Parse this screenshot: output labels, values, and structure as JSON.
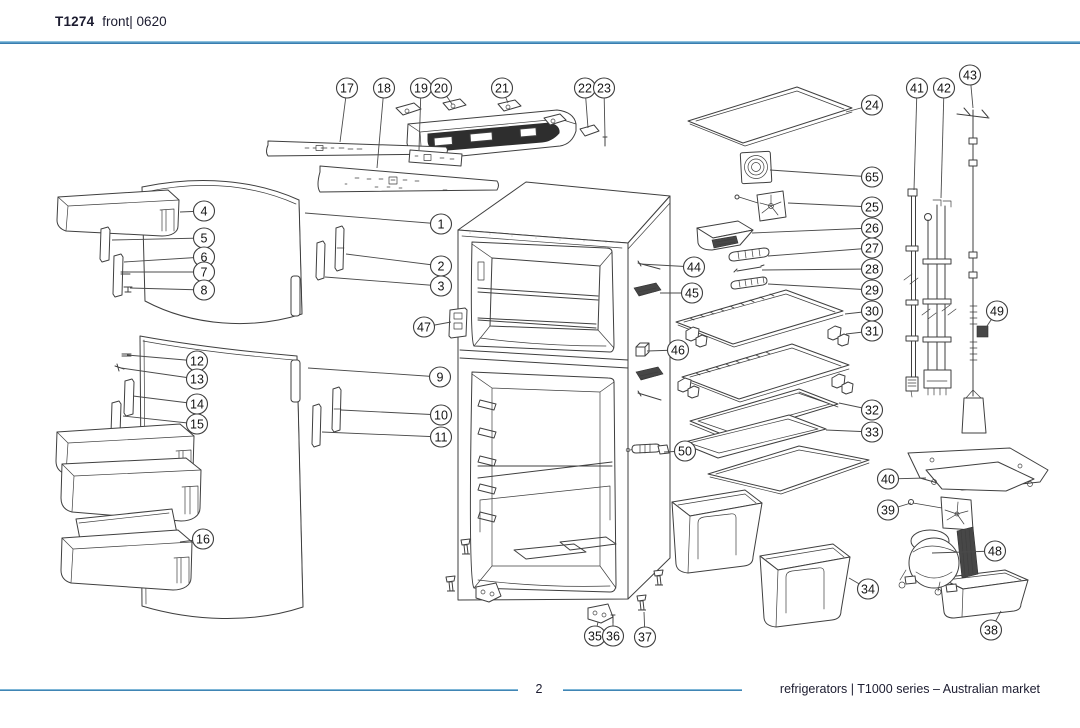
{
  "header": {
    "model": "T1274",
    "view": "front| 0620"
  },
  "footer": {
    "page": "2",
    "caption": "refrigerators | T1000 series – Australian market"
  },
  "colors": {
    "rule_blue": "#5b9fc9",
    "rule_blue_dark": "#2a6fa3",
    "ink": "#3f3f3f",
    "text": "#1c1c30"
  },
  "diagram": {
    "description": "exploded parts view of top-mount refrigerator, front",
    "callouts": [
      {
        "n": "1",
        "x": 441,
        "y": 224,
        "tx": 305,
        "ty": 213
      },
      {
        "n": "2",
        "x": 441,
        "y": 266,
        "tx": 346,
        "ty": 254
      },
      {
        "n": "3",
        "x": 441,
        "y": 286,
        "tx": 325,
        "ty": 277
      },
      {
        "n": "4",
        "x": 204,
        "y": 211,
        "tx": 180,
        "ty": 212
      },
      {
        "n": "5",
        "x": 204,
        "y": 238,
        "tx": 112,
        "ty": 240
      },
      {
        "n": "6",
        "x": 204,
        "y": 257,
        "tx": 124,
        "ty": 262
      },
      {
        "n": "7",
        "x": 204,
        "y": 272,
        "tx": 128,
        "ty": 272
      },
      {
        "n": "8",
        "x": 204,
        "y": 290,
        "tx": 130,
        "ty": 288
      },
      {
        "n": "9",
        "x": 440,
        "y": 377,
        "tx": 308,
        "ty": 368
      },
      {
        "n": "10",
        "x": 441,
        "y": 415,
        "tx": 341,
        "ty": 410
      },
      {
        "n": "11",
        "x": 441,
        "y": 437,
        "tx": 322,
        "ty": 432
      },
      {
        "n": "12",
        "x": 197,
        "y": 361,
        "tx": 127,
        "ty": 355
      },
      {
        "n": "13",
        "x": 197,
        "y": 379,
        "tx": 121,
        "ty": 368
      },
      {
        "n": "14",
        "x": 197,
        "y": 404,
        "tx": 133,
        "ty": 396
      },
      {
        "n": "15",
        "x": 197,
        "y": 424,
        "tx": 123,
        "ty": 416
      },
      {
        "n": "16",
        "x": 203,
        "y": 539,
        "tx": 180,
        "ty": 542
      },
      {
        "n": "17",
        "x": 347,
        "y": 88,
        "tx": 340,
        "ty": 142
      },
      {
        "n": "18",
        "x": 384,
        "y": 88,
        "tx": 377,
        "ty": 168
      },
      {
        "n": "19",
        "x": 421,
        "y": 88,
        "tx": 419,
        "ty": 150
      },
      {
        "n": "20",
        "x": 441,
        "y": 88,
        "tx": 452,
        "ty": 104
      },
      {
        "n": "21",
        "x": 502,
        "y": 88,
        "tx": 508,
        "ty": 103
      },
      {
        "n": "22",
        "x": 585,
        "y": 88,
        "tx": 588,
        "ty": 128
      },
      {
        "n": "23",
        "x": 604,
        "y": 88,
        "tx": 605,
        "ty": 137
      },
      {
        "n": "24",
        "x": 872,
        "y": 105,
        "tx": 846,
        "ty": 112
      },
      {
        "n": "25",
        "x": 872,
        "y": 207,
        "tx": 788,
        "ty": 203
      },
      {
        "n": "26",
        "x": 872,
        "y": 228,
        "tx": 752,
        "ty": 233
      },
      {
        "n": "27",
        "x": 872,
        "y": 248,
        "tx": 768,
        "ty": 256
      },
      {
        "n": "28",
        "x": 872,
        "y": 269,
        "tx": 762,
        "ty": 270
      },
      {
        "n": "29",
        "x": 872,
        "y": 290,
        "tx": 768,
        "ty": 284
      },
      {
        "n": "30",
        "x": 872,
        "y": 311,
        "tx": 845,
        "ty": 314
      },
      {
        "n": "31",
        "x": 872,
        "y": 331,
        "tx": 846,
        "ty": 334
      },
      {
        "n": "32",
        "x": 872,
        "y": 410,
        "tx": 839,
        "ty": 403
      },
      {
        "n": "33",
        "x": 872,
        "y": 432,
        "tx": 826,
        "ty": 430
      },
      {
        "n": "34",
        "x": 868,
        "y": 589,
        "tx": 849,
        "ty": 578
      },
      {
        "n": "35",
        "x": 595,
        "y": 636,
        "tx": 598,
        "ty": 622
      },
      {
        "n": "36",
        "x": 613,
        "y": 636,
        "tx": 613,
        "ty": 623
      },
      {
        "n": "37",
        "x": 645,
        "y": 637,
        "tx": 644,
        "ty": 612
      },
      {
        "n": "38",
        "x": 991,
        "y": 630,
        "tx": 1001,
        "ty": 611
      },
      {
        "n": "39",
        "x": 888,
        "y": 510,
        "tx": 911,
        "ty": 503
      },
      {
        "n": "40",
        "x": 888,
        "y": 479,
        "tx": 926,
        "ty": 478
      },
      {
        "n": "41",
        "x": 917,
        "y": 88,
        "tx": 914,
        "ty": 190
      },
      {
        "n": "42",
        "x": 944,
        "y": 88,
        "tx": 941,
        "ty": 198
      },
      {
        "n": "43",
        "x": 970,
        "y": 75,
        "tx": 973,
        "ty": 108
      },
      {
        "n": "44",
        "x": 694,
        "y": 267,
        "tx": 640,
        "ty": 264
      },
      {
        "n": "45",
        "x": 692,
        "y": 293,
        "tx": 660,
        "ty": 293
      },
      {
        "n": "46",
        "x": 678,
        "y": 350,
        "tx": 647,
        "ty": 351
      },
      {
        "n": "47",
        "x": 424,
        "y": 327,
        "tx": 451,
        "ty": 322
      },
      {
        "n": "48",
        "x": 995,
        "y": 551,
        "tx": 932,
        "ty": 553
      },
      {
        "n": "49",
        "x": 997,
        "y": 311,
        "tx": 985,
        "ty": 329
      },
      {
        "n": "50",
        "x": 685,
        "y": 451,
        "tx": 664,
        "ty": 452
      },
      {
        "n": "65",
        "x": 872,
        "y": 177,
        "tx": 770,
        "ty": 170
      }
    ]
  }
}
